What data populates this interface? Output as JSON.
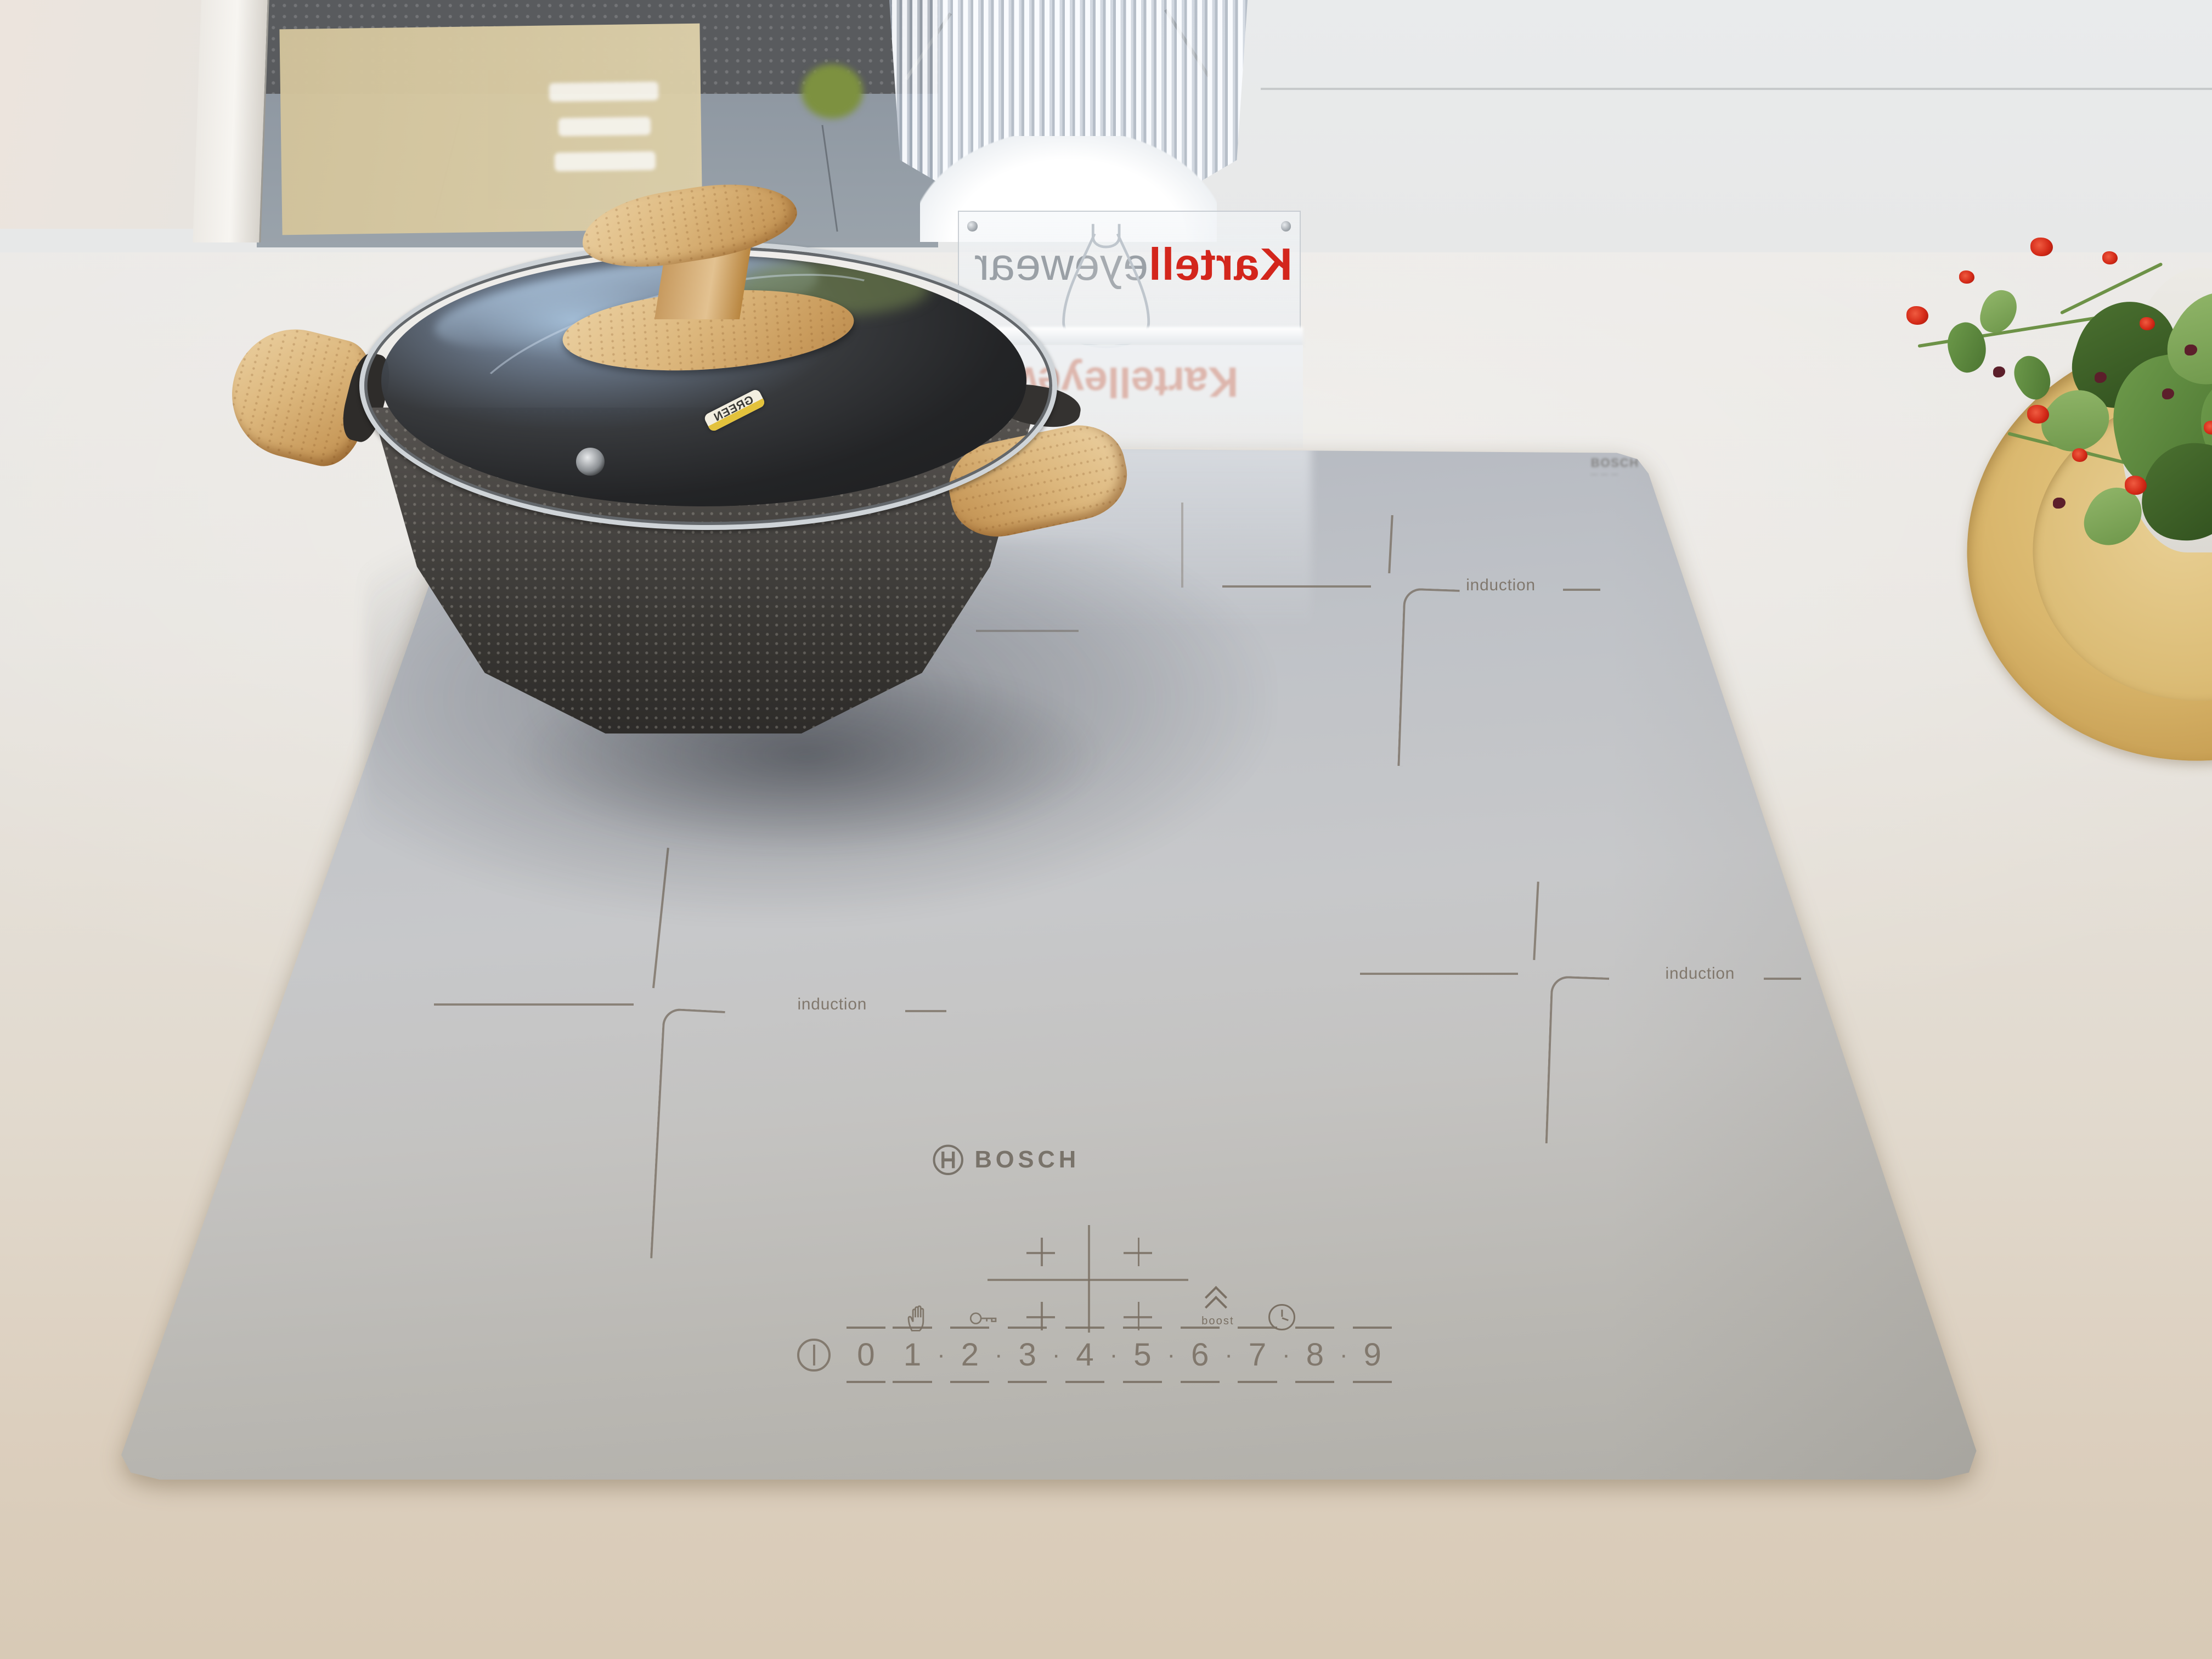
{
  "scene_type": "photo of induction cooktop in showroom",
  "stand": {
    "brand_red": "Kartell",
    "brand_gray": "eyewear",
    "reflection_text": "Kartelleyewe"
  },
  "cooktop": {
    "brand": "BOSCH",
    "corner_marking": "BOSCH",
    "zone_label": "induction",
    "controls": {
      "boost_label": "boost",
      "separator": "·",
      "levels": [
        "0",
        "1",
        "2",
        "3",
        "4",
        "5",
        "6",
        "7",
        "8",
        "9"
      ]
    }
  },
  "pot": {
    "sticker_text": "GREEN"
  },
  "colors": {
    "kartell-red": "#d3261c",
    "eyewear-gray": "#9aa0a6",
    "marking": "#7a7064",
    "bosch": "#6d665c",
    "flower-red": "#d42a18"
  }
}
